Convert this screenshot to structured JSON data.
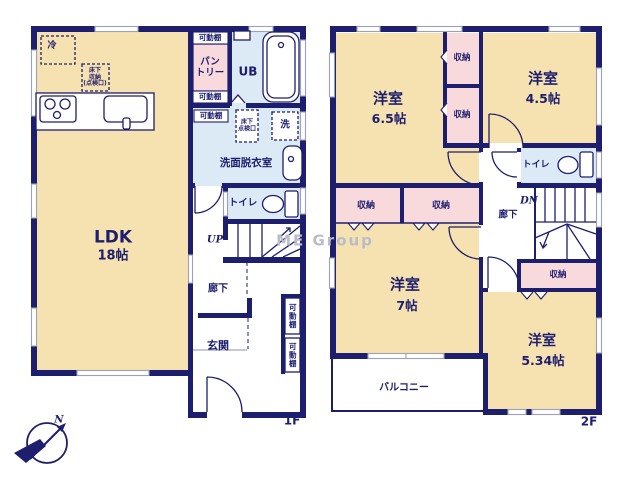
{
  "palette": {
    "wall": "#1e1e6e",
    "room_fill": "#f6e2b0",
    "closet_fill": "#f8d9dc",
    "wet_fill": "#dceaf6",
    "window_line": "#99a2b8"
  },
  "watermark": "ME Group",
  "compass": {
    "north": "N"
  },
  "floor1": {
    "label": "1F",
    "ldk_name": "LDK",
    "ldk_size": "18帖",
    "fridge": "冷",
    "underfloor_storage": "床下\n収納\n(点検口)",
    "shelf_top": "可動棚",
    "shelf_mid": "可動棚",
    "shelf_low": "可動棚",
    "pantry": "パン\nトリー",
    "unit_bath": "UB",
    "washroom": "洗面脱衣室",
    "inspection_hatch": "床下\n点検口",
    "laundry": "洗",
    "toilet": "トイレ",
    "stairs": "UP",
    "hallway": "廊下",
    "entrance": "玄関",
    "shoe_shelf_upper": "可動棚",
    "shoe_shelf_lower": "可動棚"
  },
  "floor2": {
    "label": "2F",
    "room65_name": "洋室",
    "room65_size": "6.5帖",
    "room45_name": "洋室",
    "room45_size": "4.5帖",
    "room7_name": "洋室",
    "room7_size": "7帖",
    "room534_name": "洋室",
    "room534_size": "5.34帖",
    "closet_a": "収納",
    "closet_b": "収納",
    "closet_c": "収納",
    "closet_d": "収納",
    "closet_e": "収納",
    "toilet": "トイレ",
    "stairs": "DN",
    "hallway": "廊下",
    "balcony": "バルコニー"
  }
}
